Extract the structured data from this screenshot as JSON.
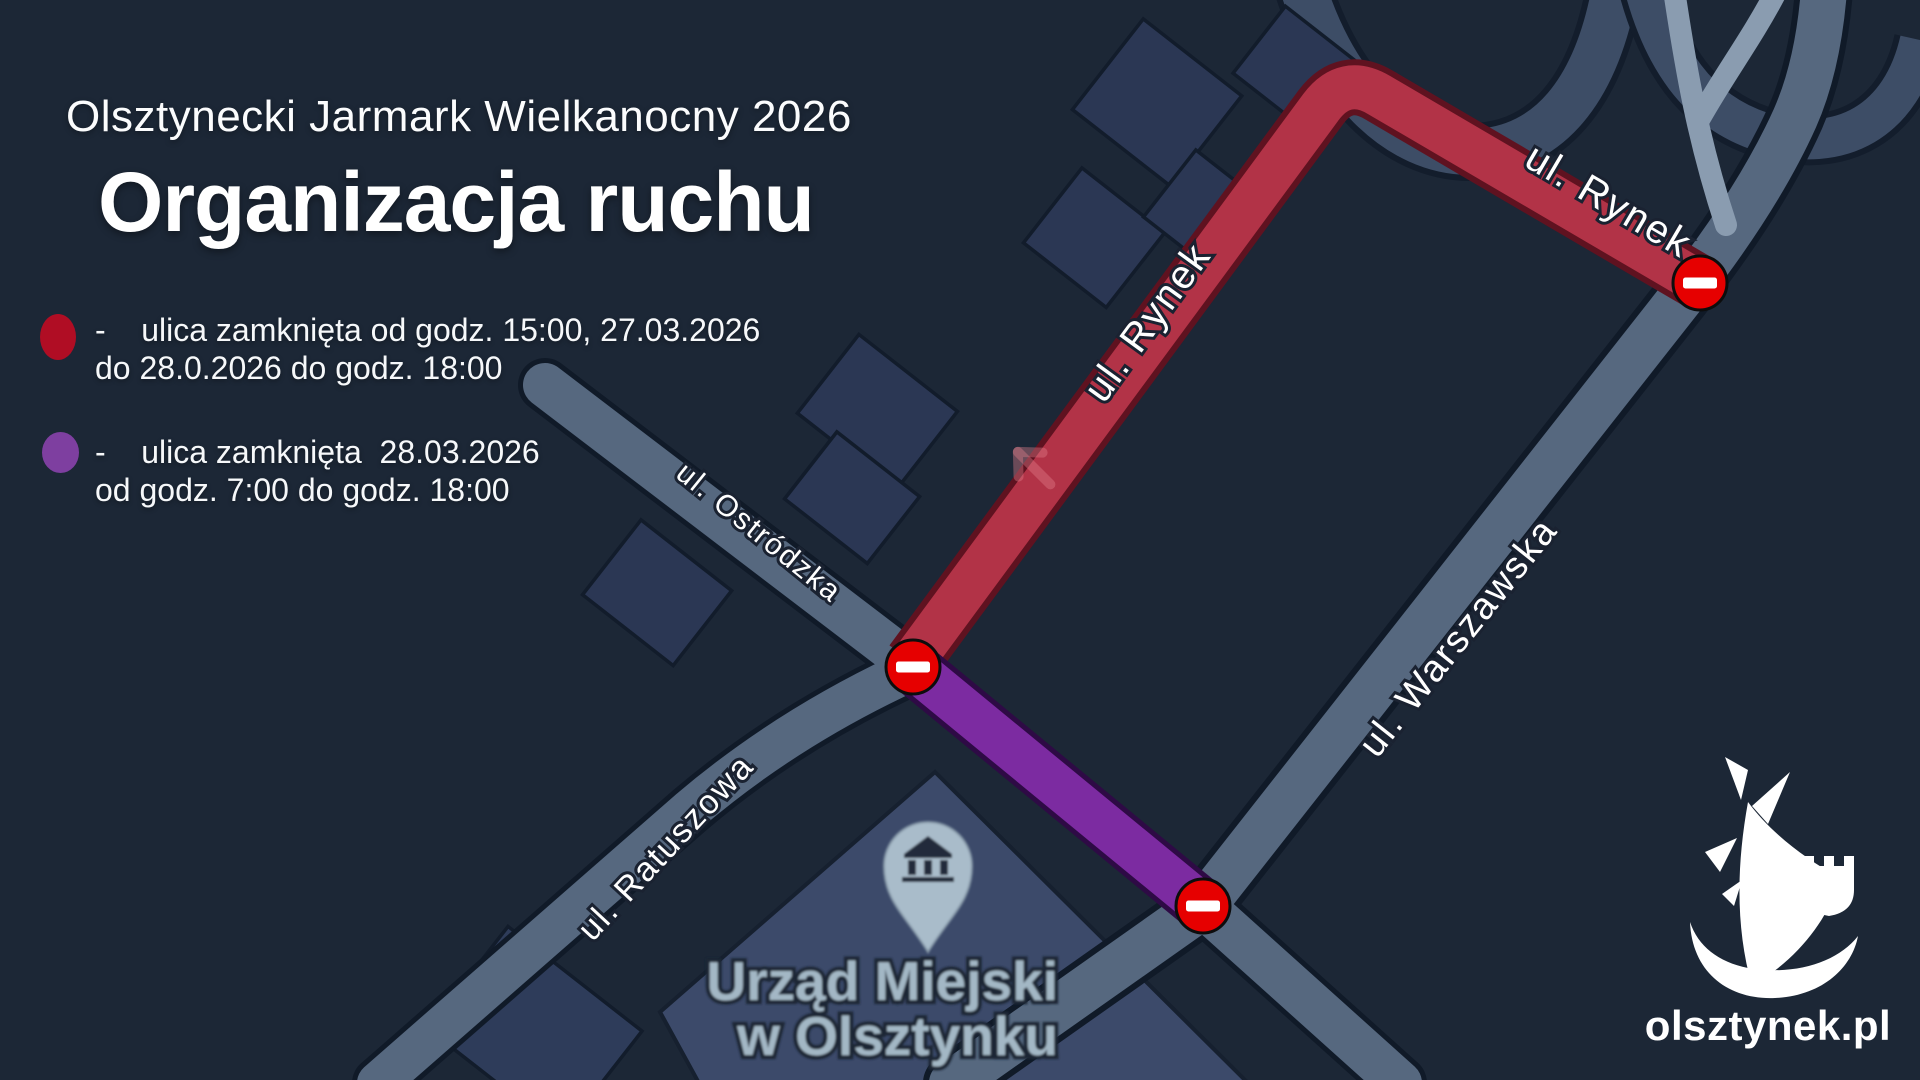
{
  "header": {
    "subtitle": "Olsztynecki Jarmark Wielkanocny 2026",
    "title": "Organizacja ruchu"
  },
  "legend": {
    "items": [
      {
        "key": "red-closure",
        "color": "#b00d24",
        "line1": "-    ulica zamknięta od godz. 15:00, 27.03.2026",
        "line2": "do 28.0.2026 do godz. 18:00"
      },
      {
        "key": "purple-closure",
        "color": "#7e3fa0",
        "line1": "-    ulica zamknięta  28.03.2026",
        "line2": "od godz. 7:00 do godz. 18:00"
      }
    ]
  },
  "map": {
    "street_labels": {
      "rynek": "ul. Rynek",
      "ostrodzka": "ul. Ostródzka",
      "warszawska": "ul. Warszawska",
      "ratuszowa": "ul. Ratuszowa"
    },
    "poi": {
      "line1": "Urząd Miejski",
      "line2": "w Olsztynku"
    },
    "colors": {
      "background": "#1c2736",
      "road": "#56687f",
      "closed_red": "#b23347",
      "closed_purple": "#7c2ba1",
      "no_entry_sign": "#e60000"
    },
    "no_entry_signs": 3
  },
  "logo": {
    "text": "olsztynek.pl"
  }
}
